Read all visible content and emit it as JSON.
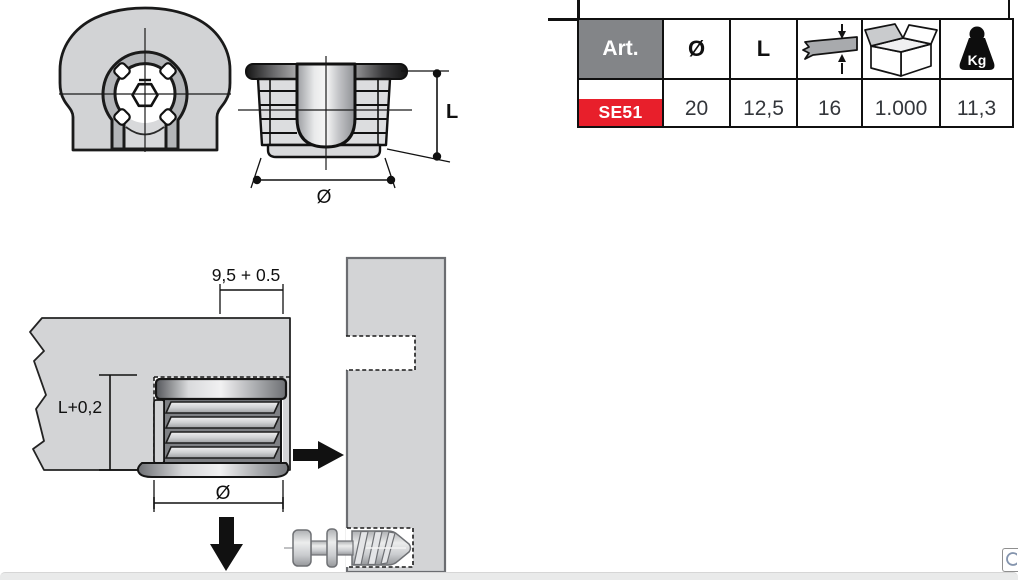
{
  "product_table": {
    "columns": {
      "art": "Art.",
      "diameter": "Ø",
      "length": "L"
    },
    "weight_icon_label": "Kg",
    "row": {
      "art": "SE51",
      "diameter": "20",
      "length": "12,5",
      "thickness": "16",
      "pack_qty": "1.000",
      "weight_kg": "11,3"
    },
    "colors": {
      "header_bg": "#838588",
      "header_text": "#ffffff",
      "art_bg": "#e81f2b",
      "art_text": "#ffffff",
      "grid": "#101010"
    }
  },
  "dimensions": {
    "side_view": {
      "height_label": "L",
      "diameter_label": "Ø"
    },
    "installation": {
      "edge_distance_label": "9,5 + 0.5",
      "depth_label": "L+0,2",
      "diameter_label": "Ø"
    }
  }
}
